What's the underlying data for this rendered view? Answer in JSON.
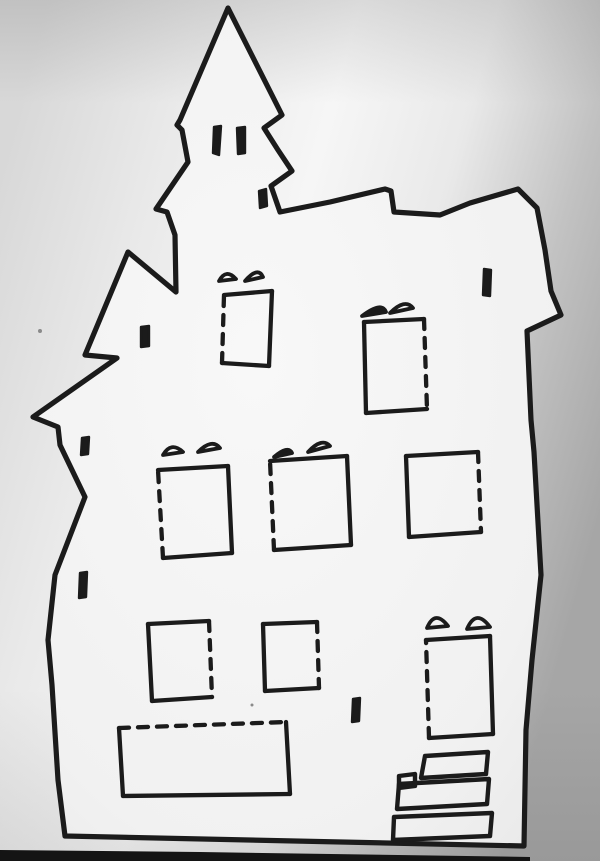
{
  "meta": {
    "description": "Photograph of a hand-drawn haunted house paper-craft template: black marker outline on white paper, dashed fold lines on window and door edges, photographed with uneven gray lighting and a dark table edge at the bottom.",
    "width": 600,
    "height": 861
  },
  "colors": {
    "ink": "#1b1b1b",
    "paper_center": "#f6f6f6",
    "paper_mid": "#e9e9e9",
    "paper_edge_left": "#d8d8d8",
    "paper_edge_right": "#a6a6a6",
    "house_fill_center": "#f8f8f8",
    "house_fill_edge": "#e7e7e7",
    "table_edge": "#141414",
    "speck": "#8a8a8a"
  },
  "strokes": {
    "outline_width": 5.2,
    "panel_width": 4.3,
    "step_width": 4.4,
    "dash_pattern": "10 9"
  },
  "drawing": {
    "outline": [
      [
        228,
        8
      ],
      [
        282,
        115
      ],
      [
        264,
        128
      ],
      [
        278,
        150
      ],
      [
        292,
        171
      ],
      [
        271,
        186
      ],
      [
        280,
        212
      ],
      [
        330,
        202
      ],
      [
        385,
        189
      ],
      [
        391,
        191
      ],
      [
        394,
        212
      ],
      [
        440,
        215
      ],
      [
        470,
        203
      ],
      [
        518,
        189
      ],
      [
        537,
        208
      ],
      [
        545,
        250
      ],
      [
        551,
        291
      ],
      [
        561,
        315
      ],
      [
        527,
        331
      ],
      [
        531,
        420
      ],
      [
        534,
        452
      ],
      [
        541,
        575
      ],
      [
        532,
        660
      ],
      [
        526,
        730
      ],
      [
        524,
        846
      ],
      [
        65,
        836
      ],
      [
        58,
        780
      ],
      [
        52,
        685
      ],
      [
        48,
        640
      ],
      [
        55,
        575
      ],
      [
        85,
        497
      ],
      [
        60,
        445
      ],
      [
        58,
        427
      ],
      [
        33,
        417
      ],
      [
        117,
        358
      ],
      [
        85,
        355
      ],
      [
        128,
        252
      ],
      [
        176,
        292
      ],
      [
        175,
        235
      ],
      [
        167,
        212
      ],
      [
        156,
        209
      ],
      [
        188,
        162
      ],
      [
        182,
        130
      ],
      [
        177,
        125
      ],
      [
        180,
        120
      ]
    ],
    "windows": [
      {
        "name": "attic-left-window",
        "corners": [
          [
            224,
            295
          ],
          [
            272,
            291
          ],
          [
            269,
            366
          ],
          [
            222,
            363
          ]
        ],
        "dashed_edges": [
          3
        ],
        "awnings": [
          {
            "from": [
              219,
              281
            ],
            "to": [
              236,
              279
            ],
            "peak": [
              226,
              268
            ],
            "filled": false
          },
          {
            "from": [
              245,
              281
            ],
            "to": [
              263,
              277
            ],
            "peak": [
              258,
              266
            ],
            "filled": false
          }
        ]
      },
      {
        "name": "attic-right-window",
        "corners": [
          [
            364,
            322
          ],
          [
            424,
            319
          ],
          [
            427,
            409
          ],
          [
            366,
            413
          ]
        ],
        "dashed_edges": [
          1
        ],
        "awnings": [
          {
            "from": [
              362,
              316
            ],
            "to": [
              386,
              312
            ],
            "peak": [
              382,
              301
            ],
            "filled": true
          },
          {
            "from": [
              390,
              313
            ],
            "to": [
              413,
              308
            ],
            "peak": [
              405,
              298
            ],
            "filled": false
          }
        ]
      },
      {
        "name": "second-floor-left-window",
        "corners": [
          [
            158,
            470
          ],
          [
            228,
            466
          ],
          [
            232,
            553
          ],
          [
            163,
            558
          ]
        ],
        "dashed_edges": [
          3
        ],
        "awnings": [
          {
            "from": [
              163,
              455
            ],
            "to": [
              183,
              452
            ],
            "peak": [
              171,
              441
            ],
            "filled": false
          },
          {
            "from": [
              198,
              452
            ],
            "to": [
              220,
              448
            ],
            "peak": [
              212,
              438
            ],
            "filled": false
          }
        ]
      },
      {
        "name": "second-floor-middle-window",
        "corners": [
          [
            270,
            461
          ],
          [
            347,
            456
          ],
          [
            351,
            545
          ],
          [
            274,
            550
          ]
        ],
        "dashed_edges": [
          3
        ],
        "awnings": [
          {
            "from": [
              274,
              457
            ],
            "to": [
              292,
              453
            ],
            "peak": [
              288,
              445
            ],
            "filled": true
          },
          {
            "from": [
              308,
              452
            ],
            "to": [
              330,
              446
            ],
            "peak": [
              322,
              437
            ],
            "filled": false
          }
        ]
      },
      {
        "name": "second-floor-right-window",
        "corners": [
          [
            406,
            456
          ],
          [
            478,
            452
          ],
          [
            481,
            532
          ],
          [
            409,
            537
          ]
        ],
        "dashed_edges": [
          1
        ],
        "awnings": []
      },
      {
        "name": "first-floor-left-window",
        "corners": [
          [
            148,
            624
          ],
          [
            209,
            621
          ],
          [
            212,
            697
          ],
          [
            152,
            701
          ]
        ],
        "dashed_edges": [
          1
        ],
        "awnings": []
      },
      {
        "name": "first-floor-middle-window",
        "corners": [
          [
            263,
            624
          ],
          [
            317,
            622
          ],
          [
            319,
            688
          ],
          [
            265,
            691
          ]
        ],
        "dashed_edges": [
          1
        ],
        "awnings": []
      },
      {
        "name": "basement-panel",
        "corners": [
          [
            119,
            728
          ],
          [
            286,
            722
          ],
          [
            290,
            794
          ],
          [
            123,
            796
          ]
        ],
        "dashed_edges": [
          0
        ],
        "awnings": []
      },
      {
        "name": "front-door",
        "corners": [
          [
            426,
            640
          ],
          [
            490,
            636
          ],
          [
            493,
            734
          ],
          [
            429,
            738
          ]
        ],
        "dashed_edges": [
          3
        ],
        "awnings": [
          {
            "from": [
              427,
              628
            ],
            "to": [
              448,
              626
            ],
            "peak": [
              435,
              609
            ],
            "filled": false
          },
          {
            "from": [
              467,
              629
            ],
            "to": [
              490,
              627
            ],
            "peak": [
              476,
              608
            ],
            "filled": false
          }
        ]
      }
    ],
    "slits": [
      {
        "name": "tower-slit-left",
        "corners": [
          [
            214,
            127
          ],
          [
            221,
            126
          ],
          [
            219,
            155
          ],
          [
            213,
            153
          ]
        ]
      },
      {
        "name": "tower-slit-right",
        "corners": [
          [
            237,
            128
          ],
          [
            245,
            127
          ],
          [
            245,
            153
          ],
          [
            238,
            154
          ]
        ]
      },
      {
        "name": "tower-base-slit",
        "corners": [
          [
            259,
            191
          ],
          [
            266,
            189
          ],
          [
            267,
            206
          ],
          [
            260,
            208
          ]
        ]
      },
      {
        "name": "left-attic-slit",
        "corners": [
          [
            141,
            327
          ],
          [
            149,
            326
          ],
          [
            149,
            346
          ],
          [
            141,
            347
          ]
        ]
      },
      {
        "name": "right-wall-slit",
        "corners": [
          [
            484,
            269
          ],
          [
            491,
            270
          ],
          [
            490,
            296
          ],
          [
            483,
            295
          ]
        ]
      },
      {
        "name": "left-wall-upper-slit",
        "corners": [
          [
            82,
            438
          ],
          [
            89,
            437
          ],
          [
            88,
            454
          ],
          [
            81,
            455
          ]
        ]
      },
      {
        "name": "left-wall-lower-slit",
        "corners": [
          [
            80,
            573
          ],
          [
            87,
            572
          ],
          [
            86,
            597
          ],
          [
            79,
            598
          ]
        ]
      },
      {
        "name": "lower-wall-slit",
        "corners": [
          [
            353,
            699
          ],
          [
            360,
            698
          ],
          [
            359,
            721
          ],
          [
            352,
            722
          ]
        ]
      }
    ],
    "steps": [
      {
        "name": "stair-step-1",
        "corners": [
          [
            425,
            756
          ],
          [
            488,
            752
          ],
          [
            486,
            774
          ],
          [
            421,
            778
          ]
        ]
      },
      {
        "name": "stair-step-2",
        "corners": [
          [
            399,
            784
          ],
          [
            489,
            779
          ],
          [
            487,
            804
          ],
          [
            397,
            809
          ]
        ]
      },
      {
        "name": "stair-step-2-notch",
        "corners": [
          [
            399,
            776
          ],
          [
            415,
            774
          ],
          [
            415,
            786
          ],
          [
            399,
            788
          ]
        ]
      },
      {
        "name": "stair-step-3",
        "corners": [
          [
            394,
            817
          ],
          [
            492,
            813
          ],
          [
            490,
            836
          ],
          [
            393,
            840
          ]
        ]
      }
    ],
    "table_edge": [
      [
        0,
        850
      ],
      [
        200,
        852
      ],
      [
        530,
        857
      ],
      [
        530,
        861
      ],
      [
        0,
        861
      ]
    ],
    "specks": [
      {
        "x": 40,
        "y": 331,
        "r": 2
      },
      {
        "x": 252,
        "y": 705,
        "r": 1.5
      }
    ]
  }
}
